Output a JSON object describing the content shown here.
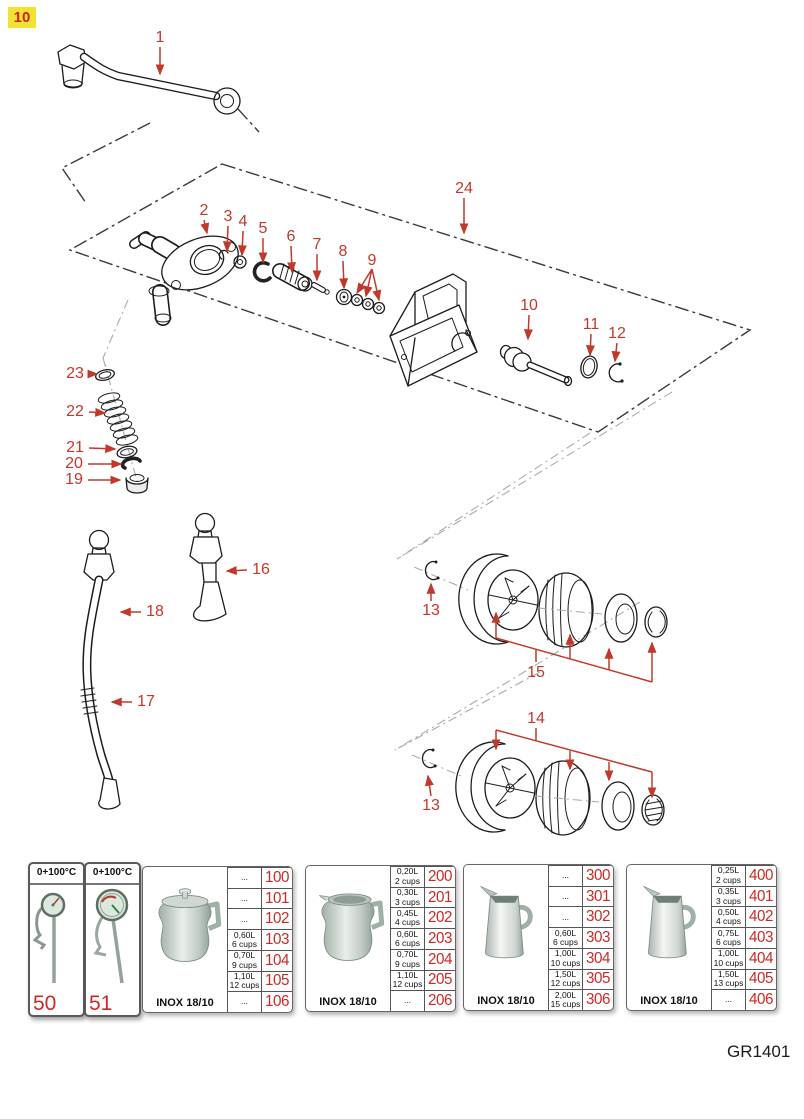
{
  "page": {
    "badge": "10",
    "drawing_code": "GR1401"
  },
  "diagram": {
    "callouts": [
      "1",
      "2",
      "3",
      "4",
      "5",
      "6",
      "7",
      "8",
      "9",
      "24",
      "10",
      "11",
      "12",
      "23",
      "22",
      "21",
      "20",
      "19",
      "16",
      "18",
      "17",
      "13",
      "15",
      "14",
      "13"
    ]
  },
  "table": {
    "thermometers": [
      {
        "range": "0+100°C",
        "code": "50"
      },
      {
        "range": "0+100°C",
        "code": "51"
      }
    ],
    "pitchers": [
      {
        "material": "INOX 18/10",
        "rows": [
          {
            "size": "...",
            "cups": "",
            "code": "100"
          },
          {
            "size": "...",
            "cups": "",
            "code": "101"
          },
          {
            "size": "...",
            "cups": "",
            "code": "102"
          },
          {
            "size": "0,60L",
            "cups": "6 cups",
            "code": "103"
          },
          {
            "size": "0,70L",
            "cups": "9 cups",
            "code": "104"
          },
          {
            "size": "1,10L",
            "cups": "12 cups",
            "code": "105"
          },
          {
            "size": "...",
            "cups": "",
            "code": "106"
          }
        ]
      },
      {
        "material": "INOX 18/10",
        "rows": [
          {
            "size": "0,20L",
            "cups": "2 cups",
            "code": "200"
          },
          {
            "size": "0,30L",
            "cups": "3 cups",
            "code": "201"
          },
          {
            "size": "0,45L",
            "cups": "4 cups",
            "code": "202"
          },
          {
            "size": "0,60L",
            "cups": "6 cups",
            "code": "203"
          },
          {
            "size": "0,70L",
            "cups": "9 cups",
            "code": "204"
          },
          {
            "size": "1,10L",
            "cups": "12 cups",
            "code": "205"
          },
          {
            "size": "...",
            "cups": "",
            "code": "206"
          }
        ]
      },
      {
        "material": "INOX 18/10",
        "rows": [
          {
            "size": "...",
            "cups": "",
            "code": "300"
          },
          {
            "size": "...",
            "cups": "",
            "code": "301"
          },
          {
            "size": "...",
            "cups": "",
            "code": "302"
          },
          {
            "size": "0,60L",
            "cups": "6 cups",
            "code": "303"
          },
          {
            "size": "1,00L",
            "cups": "10 cups",
            "code": "304"
          },
          {
            "size": "1,50L",
            "cups": "12 cups",
            "code": "305"
          },
          {
            "size": "2,00L",
            "cups": "15 cups",
            "code": "306"
          }
        ]
      },
      {
        "material": "INOX 18/10",
        "rows": [
          {
            "size": "0,25L",
            "cups": "2 cups",
            "code": "400"
          },
          {
            "size": "0,35L",
            "cups": "3 cups",
            "code": "401"
          },
          {
            "size": "0,50L",
            "cups": "4 cups",
            "code": "402"
          },
          {
            "size": "0,75L",
            "cups": "6 cups",
            "code": "403"
          },
          {
            "size": "1,00L",
            "cups": "10 cups",
            "code": "404"
          },
          {
            "size": "1,50L",
            "cups": "13 cups",
            "code": "405"
          },
          {
            "size": "...",
            "cups": "",
            "code": "406"
          }
        ]
      }
    ]
  }
}
